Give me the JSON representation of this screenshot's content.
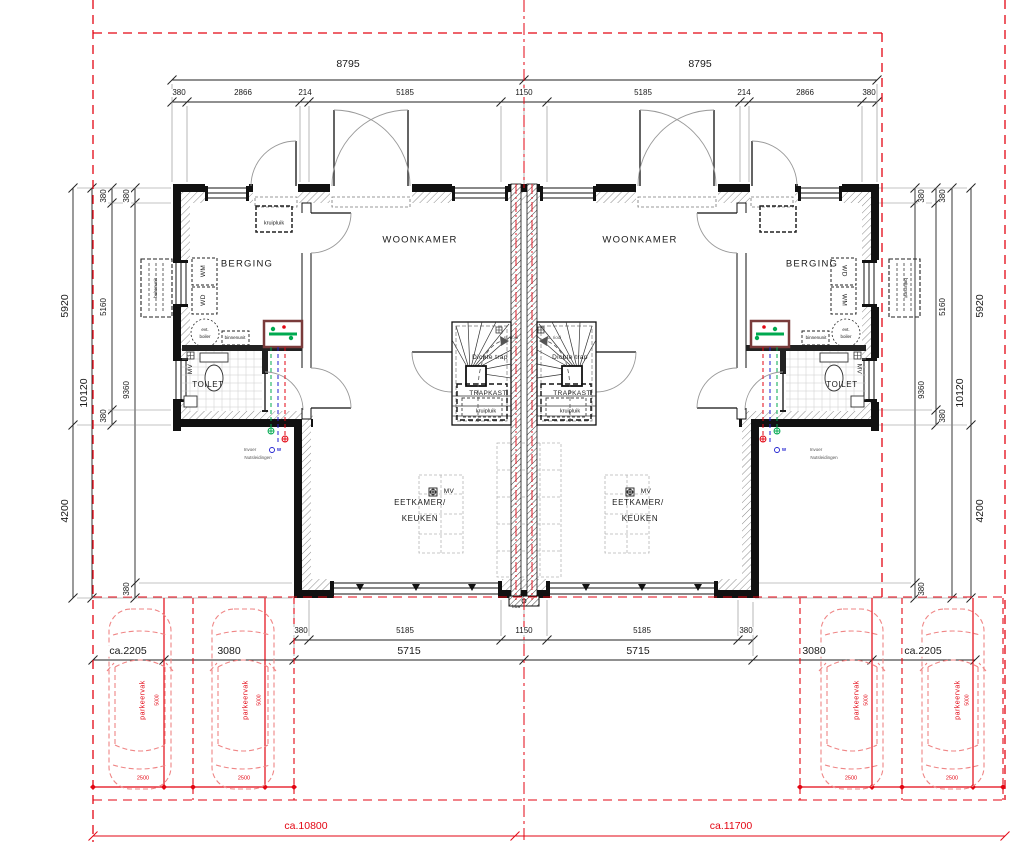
{
  "colors": {
    "red": "#e30613",
    "green": "#00a94f",
    "blue": "#1f1fd0",
    "wall": "#111111",
    "hatch_gray": "#8a8a8a"
  },
  "dims": {
    "top_overall": [
      "8795",
      "8795"
    ],
    "top_segments": [
      "380",
      "2866",
      "214",
      "5185",
      "1150",
      "5185",
      "214",
      "2866",
      "380"
    ],
    "left_outer": [
      "5920",
      "10120",
      "4200"
    ],
    "left_inner_a": [
      "380",
      "5160",
      "380"
    ],
    "left_inner_b": [
      "380",
      "9360",
      "380"
    ],
    "right_outer": [
      "5920",
      "10120",
      "4200"
    ],
    "right_inner_a": [
      "380",
      "5160",
      "380"
    ],
    "right_inner_b": [
      "380",
      "9360",
      "380"
    ],
    "bottom_segments": [
      "380",
      "5185",
      "1150",
      "5185",
      "380"
    ],
    "bottom_halves": [
      "5715",
      "5715"
    ],
    "parking_left": [
      "ca.2205",
      "3080"
    ],
    "parking_right": [
      "3080",
      "ca.2205"
    ],
    "plot_widths": [
      "ca.10800",
      "ca.11700"
    ]
  },
  "rooms": {
    "woonkamer": "WOONKAMER",
    "berging": "BERGING",
    "toilet": "TOILET",
    "eetkamer_line1": "EETKAMER/",
    "eetkamer_line2": "KEUKEN",
    "dichte_trap": "Dichte trap",
    "trapkast": "TRAPKAST"
  },
  "labels": {
    "kruipluik": "kruipluik",
    "wm": "WM",
    "wd": "WD",
    "boiler_line1": "evt.",
    "boiler_line2": "boiler",
    "binnenunit": "binnenunit",
    "buitenunit": "buitenunit",
    "mv": "MV",
    "st_riool": "st. riool",
    "invoer_line1": "Invoer",
    "invoer_line2": "Nutsleidingen",
    "hwa": "hwa",
    "water": "W"
  },
  "parking": {
    "vak_label": "parkeervak",
    "depth": "5000",
    "width": "2500"
  }
}
